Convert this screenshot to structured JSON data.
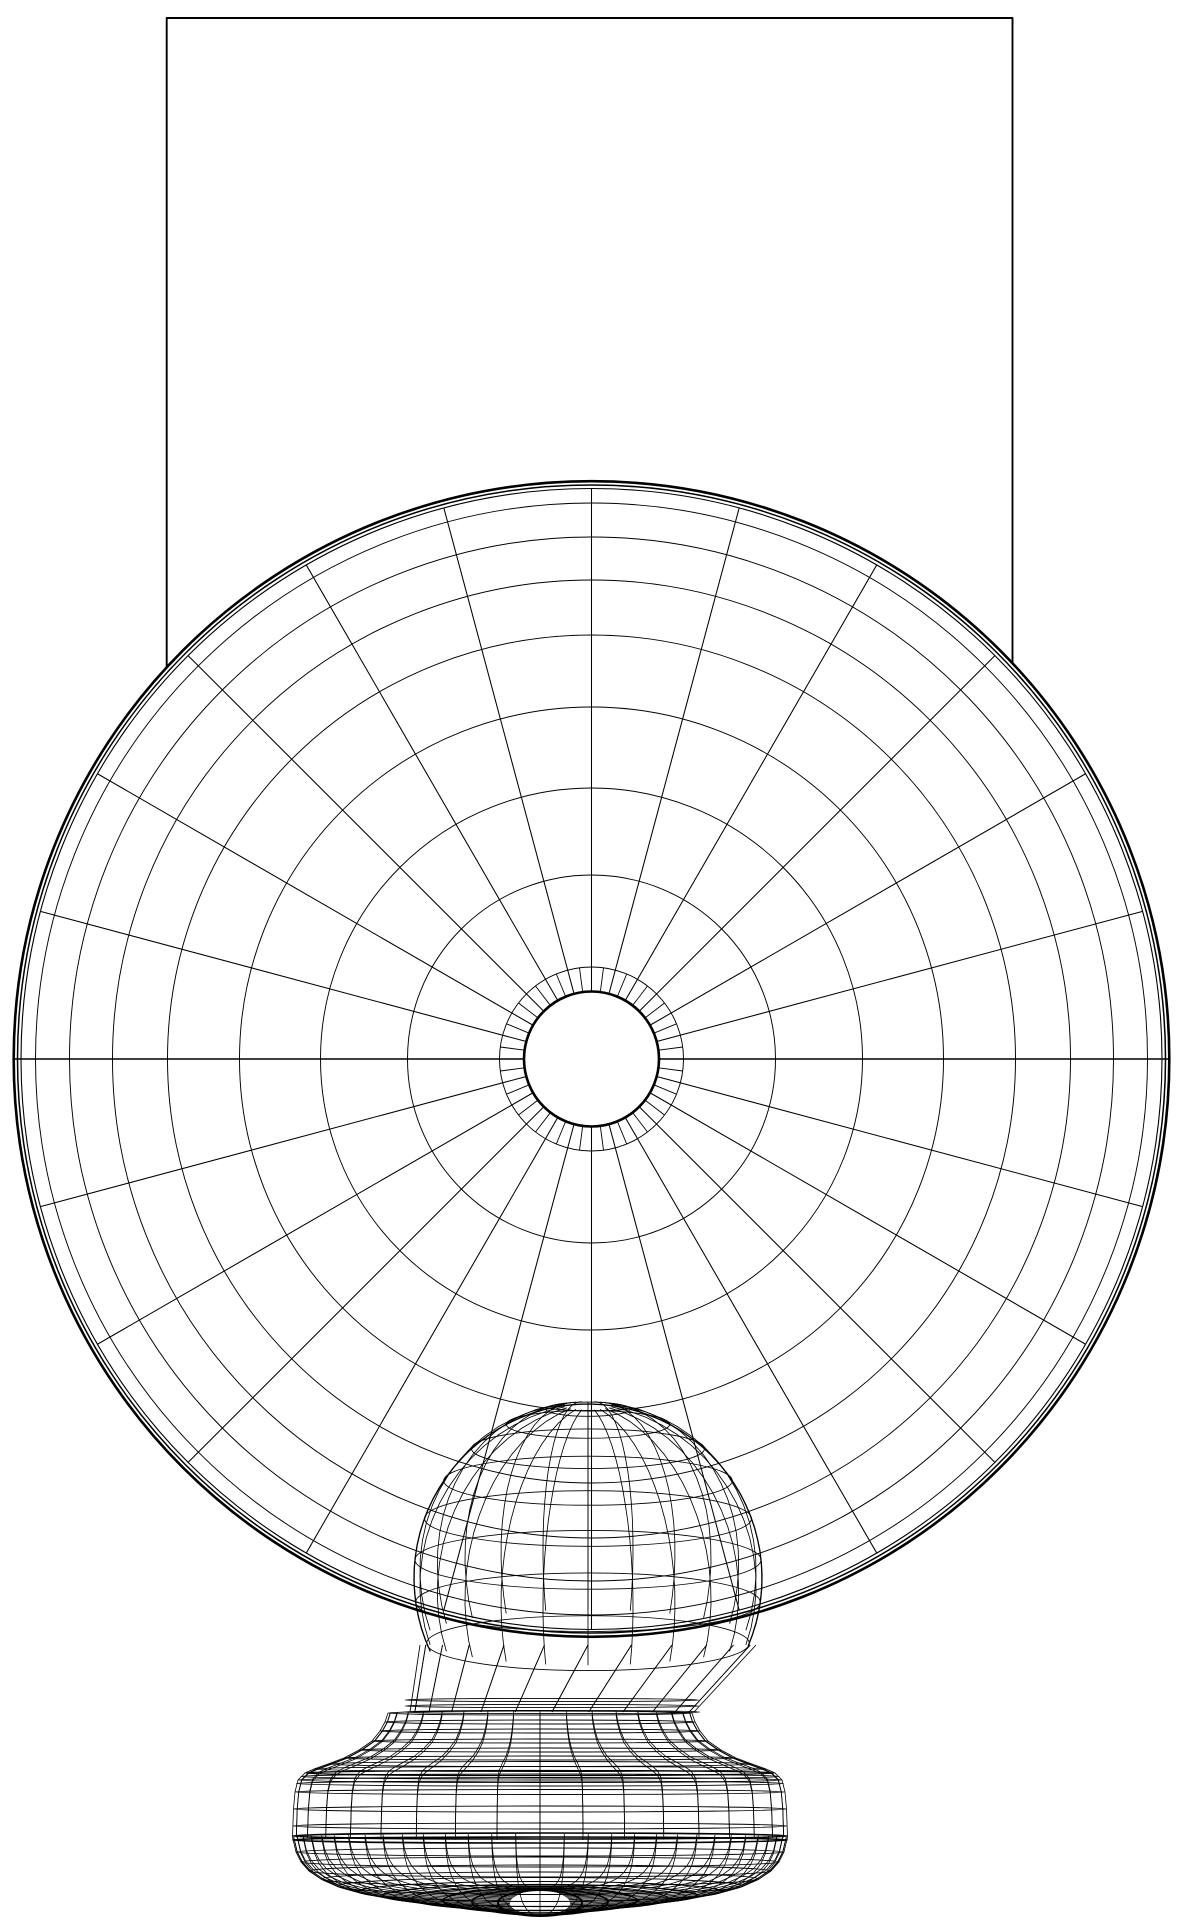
{
  "figure": {
    "kind": "cad-wireframe-render",
    "description": "Monochrome hidden-line wireframe of a spherical head on a turned pedestal stand in front of a rectangular backdrop plane",
    "background_color": "#ffffff",
    "line_color": "#000000"
  },
  "canvas": {
    "width": 1180,
    "height": 1920
  },
  "backdrop": {
    "left": 166.7,
    "top": 18,
    "right": 1012.5,
    "edge_drop": 950,
    "stroke": 1.9
  },
  "sphere": {
    "cx": 591.5,
    "cy": 1059,
    "r": 578.5,
    "hub": {
      "r": 67.5,
      "stroke": 2.6
    },
    "inner_ring_r": 92,
    "ring_radii": [
      92,
      184,
      271,
      352,
      424,
      479,
      522,
      556
    ],
    "ring_stroke": 0.95,
    "rim": [
      [
        570.5,
        1.1
      ],
      [
        574.0,
        1.5
      ],
      [
        577.8,
        2.6
      ]
    ],
    "spokes": {
      "count": 24,
      "r_in": 67.5,
      "r_out": 570.5,
      "stroke": 1.05
    },
    "short_spokes": {
      "count": 48,
      "r_in": 67.5,
      "r_out": 92,
      "stroke": 0.9
    },
    "equator": {
      "y": 1059,
      "stroke": 1.4
    }
  },
  "dome": {
    "cx": 588,
    "cy": 1578,
    "r": 174,
    "ry_ratio": 0.17,
    "rings_deg": [
      14,
      28,
      42,
      56,
      70,
      84,
      98,
      112
    ],
    "meridians": 24,
    "outline_deg": 115,
    "stroke": 0.85,
    "outline_stroke": 1.3
  },
  "neck": {
    "top": {
      "cx": 588,
      "r": 168,
      "y": 1645
    },
    "bot": {
      "cx": 552,
      "r": 142,
      "y": 1712
    },
    "meridians": 24,
    "rings": [
      [
        1700,
        147
      ],
      [
        1706,
        147
      ],
      [
        1712,
        148
      ]
    ],
    "stroke": 0.85
  },
  "base": {
    "cx": 540,
    "rings": [
      [
        1713,
        152,
        2,
        0.9
      ],
      [
        1722,
        155,
        2,
        0.9
      ],
      [
        1731,
        160,
        2,
        0.9
      ],
      [
        1741,
        168,
        2,
        0.9
      ],
      [
        1750,
        181,
        2,
        0.9
      ],
      [
        1758,
        196,
        2,
        0.9
      ],
      [
        1764,
        212,
        2.5,
        0.9
      ],
      [
        1769,
        226,
        2.5,
        0.9
      ],
      [
        1773,
        235,
        2.5,
        1.3
      ],
      [
        1776.5,
        239,
        2.5,
        0.9
      ],
      [
        1780,
        242,
        2.5,
        0.9
      ],
      [
        1783.5,
        243.5,
        2.5,
        0.9
      ],
      [
        1792,
        245,
        2.5,
        0.9
      ],
      [
        1809,
        246.5,
        3,
        0.9
      ],
      [
        1826,
        247,
        3,
        0.9
      ],
      [
        1836,
        247.5,
        3,
        1.6
      ],
      [
        1840,
        247.5,
        3,
        1.6
      ],
      [
        1852,
        244,
        4,
        0.9
      ],
      [
        1862,
        239,
        5,
        0.9
      ],
      [
        1871,
        231,
        6,
        0.9
      ],
      [
        1879,
        219,
        7,
        0.9
      ],
      [
        1886,
        203,
        8.5,
        0.9
      ],
      [
        1891.5,
        182,
        10,
        1.0
      ],
      [
        1895.5,
        157,
        11,
        1.2
      ],
      [
        1898.5,
        128,
        12,
        1.4
      ],
      [
        1900.5,
        97,
        12.5,
        1.6
      ],
      [
        1902,
        68,
        13,
        1.8
      ],
      [
        1903,
        42,
        13,
        2.0
      ]
    ],
    "meridian_profile_up": [
      [
        1713,
        152,
        2
      ],
      [
        1722,
        155,
        2
      ],
      [
        1731,
        160,
        2
      ],
      [
        1741,
        168,
        2
      ],
      [
        1750,
        181,
        2
      ],
      [
        1758,
        196,
        2
      ],
      [
        1764,
        212,
        2.5
      ],
      [
        1769,
        226,
        2.5
      ],
      [
        1773,
        235,
        2.5
      ],
      [
        1780,
        242,
        2.5
      ],
      [
        1792,
        245,
        2.5
      ],
      [
        1809,
        246.5,
        3
      ],
      [
        1837,
        247.5,
        3
      ]
    ],
    "meridian_profile_dn": [
      [
        1837,
        247.5,
        3
      ],
      [
        1852,
        244,
        4
      ],
      [
        1862,
        239,
        5
      ],
      [
        1871,
        231,
        6
      ],
      [
        1879,
        219,
        7
      ],
      [
        1886,
        203,
        8.5
      ],
      [
        1891.5,
        182,
        10
      ],
      [
        1895.5,
        157,
        11
      ],
      [
        1898.5,
        128,
        12
      ],
      [
        1900.5,
        97,
        12.5
      ],
      [
        1902,
        68,
        13
      ],
      [
        1903.5,
        30,
        13
      ]
    ],
    "meridians_up": 36,
    "meridians_dn": 64,
    "stroke": 0.8
  }
}
